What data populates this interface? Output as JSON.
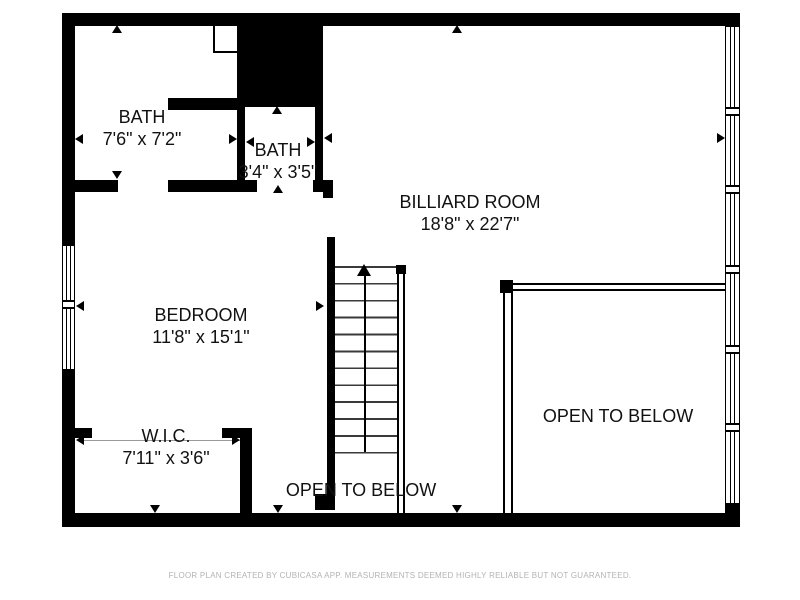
{
  "floor_plan": {
    "rooms": [
      {
        "name": "BATH",
        "dims": "7'6\" x 7'2\""
      },
      {
        "name": "BATH",
        "dims": "3'4\" x 3'5\""
      },
      {
        "name": "BILLIARD ROOM",
        "dims": "18'8\" x 22'7\""
      },
      {
        "name": "BEDROOM",
        "dims": "11'8\" x 15'1\""
      },
      {
        "name": "W.I.C.",
        "dims": "7'11\" x 3'6\""
      }
    ],
    "open_areas": [
      {
        "label": "OPEN TO BELOW",
        "position": "stairwell-center"
      },
      {
        "label": "OPEN TO BELOW",
        "position": "right"
      }
    ],
    "stairs": {
      "direction": "up",
      "arrow": "up-arrow"
    },
    "footer": "FLOOR PLAN CREATED BY CUBICASA APP. MEASUREMENTS DEEMED HIGHLY RELIABLE BUT NOT GUARANTEED.",
    "colors": {
      "wall": "#000000",
      "background": "#ffffff",
      "label_text": "#111111",
      "footer_text": "#b3b3b3"
    }
  }
}
